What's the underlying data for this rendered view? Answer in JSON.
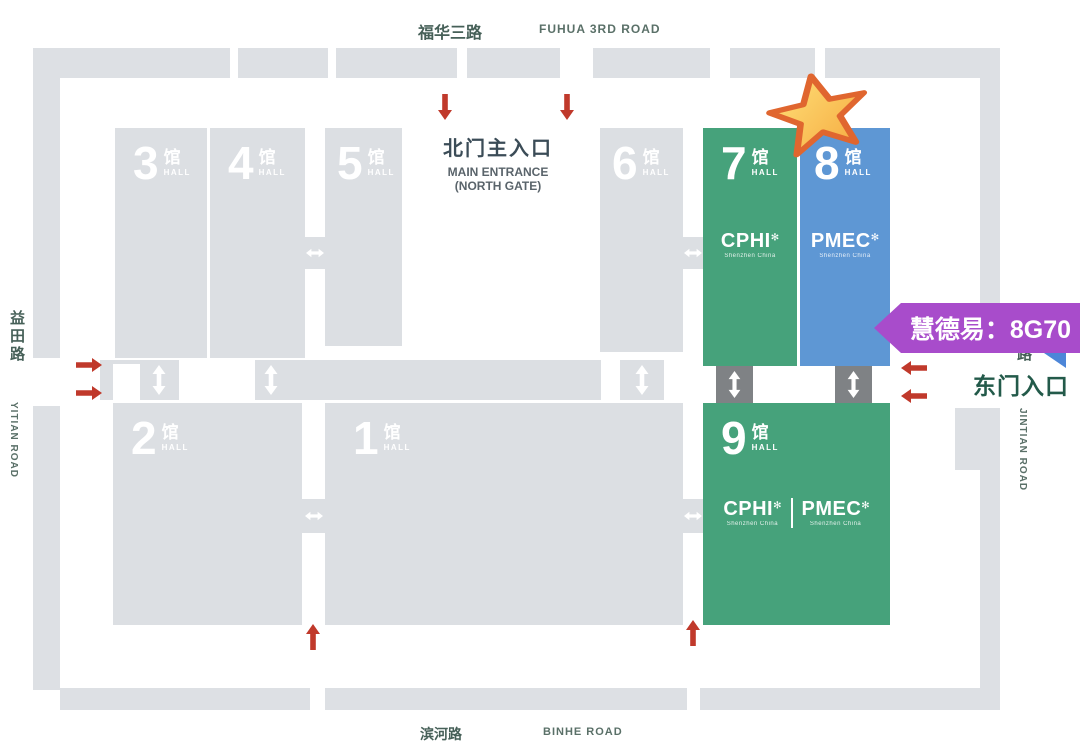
{
  "roads": {
    "fuhua_cn": "福华三路",
    "fuhua_en": "FUHUA 3RD ROAD",
    "binhe_cn": "滨河路",
    "binhe_en": "BINHE ROAD",
    "yitian_cn": "益田路",
    "yitian_en": "YITIAN ROAD",
    "jintian_cn": "路",
    "jintian_en": "JINTIAN ROAD"
  },
  "entrances": {
    "north_cn": "北门主入口",
    "north_en_line1": "MAIN ENTRANCE",
    "north_en_line2": "(NORTH GATE)",
    "east_cn": "东门入口"
  },
  "hall_suffix_cn": "馆",
  "hall_suffix_en": "HALL",
  "halls": {
    "h1": {
      "num": "1"
    },
    "h2": {
      "num": "2"
    },
    "h3": {
      "num": "3"
    },
    "h4": {
      "num": "4"
    },
    "h5": {
      "num": "5"
    },
    "h6": {
      "num": "6"
    },
    "h7": {
      "num": "7"
    },
    "h8": {
      "num": "8"
    },
    "h9": {
      "num": "9"
    }
  },
  "brands": {
    "cphi": "CPHI",
    "pmec": "PMEC",
    "subtitle": "Shenzhen China",
    "starburst": "✻"
  },
  "callout": {
    "text": "慧德易：8G70"
  },
  "colors": {
    "hall_gray": "#dcdfe3",
    "wall_gray": "#dde0e4",
    "green": "#46a27b",
    "blue": "#5e97d4",
    "dark_gray": "#7f8285",
    "red": "#c0392b",
    "purple": "#a84ccb",
    "ribbon_blue": "#4d86d8",
    "star_fill": "#fbc94f",
    "star_stroke": "#e0662f",
    "road_text": "#466058",
    "east_text": "#235a4a"
  }
}
